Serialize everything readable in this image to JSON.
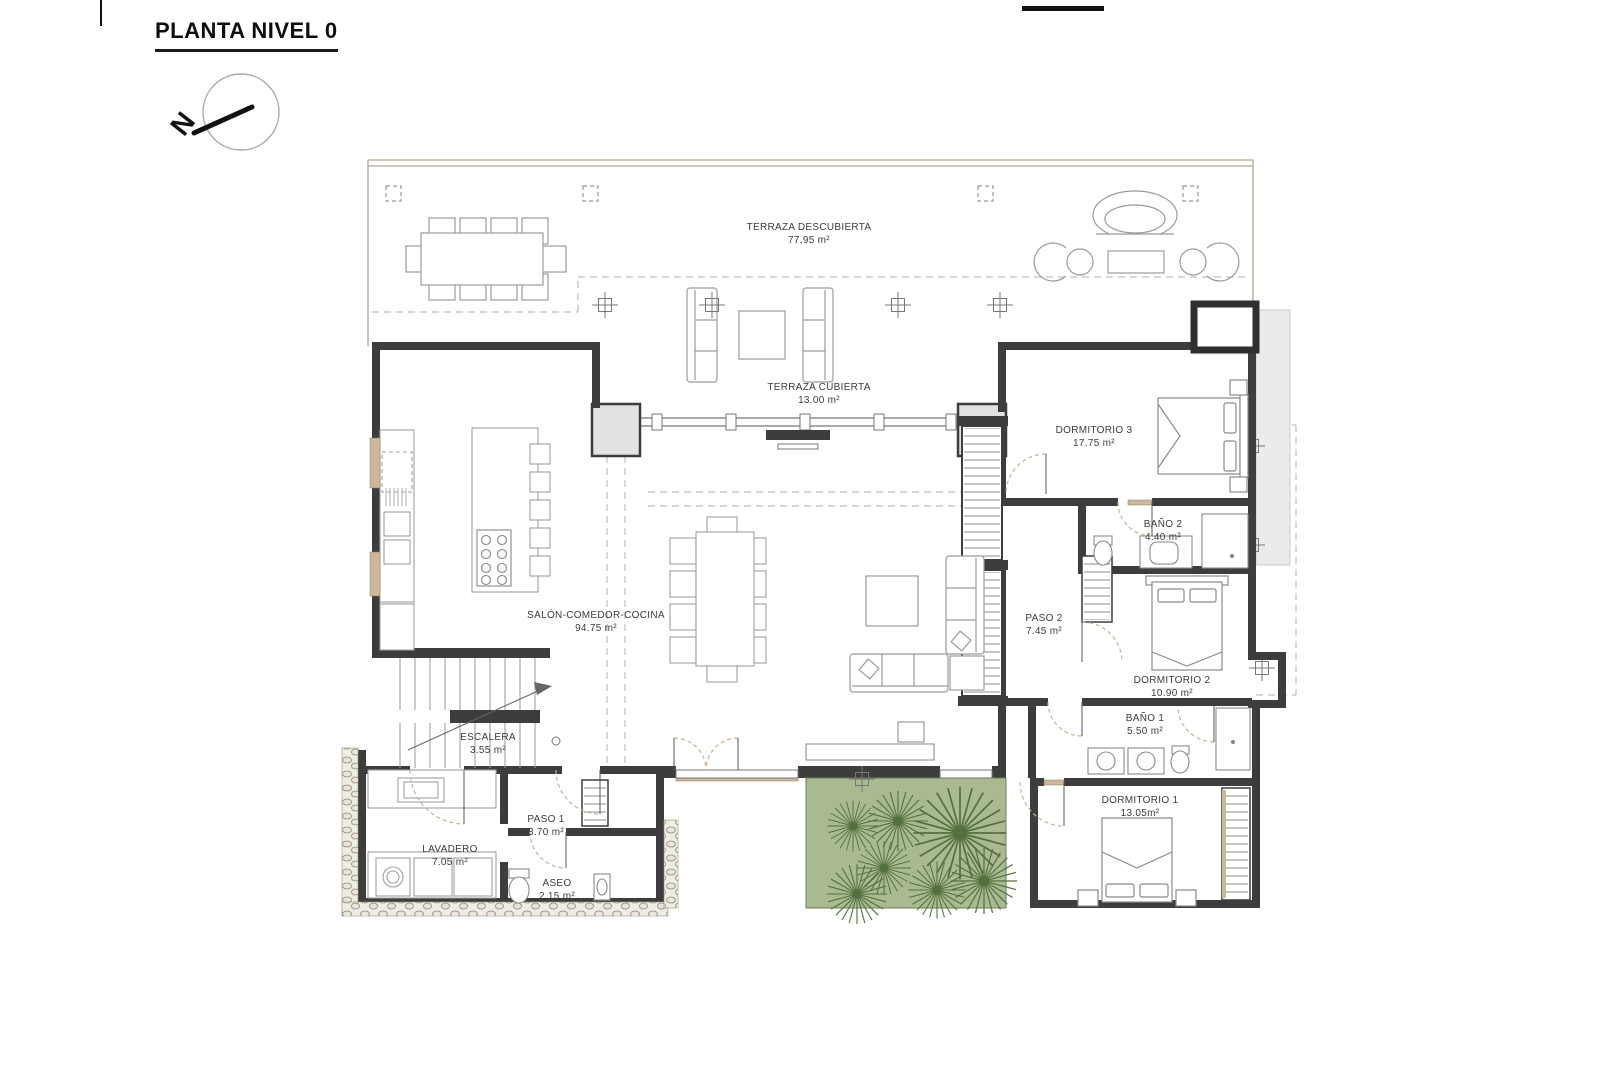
{
  "title": "PLANTA NIVEL 0",
  "compass": {
    "north_letter": "N"
  },
  "rooms": [
    {
      "id": "terraza-descubierta",
      "name": "TERRAZA DESCUBIERTA",
      "area": "77,95 m²"
    },
    {
      "id": "terraza-cubierta",
      "name": "TERRAZA CUBIERTA",
      "area": "13.00 m²"
    },
    {
      "id": "salon-comedor-cocina",
      "name": "SALÓN-COMEDOR-COCINA",
      "area": "94.75 m²"
    },
    {
      "id": "escalera",
      "name": "ESCALERA",
      "area": "3.55 m²"
    },
    {
      "id": "paso-1",
      "name": "PASO 1",
      "area": "3.70 m²"
    },
    {
      "id": "lavadero",
      "name": "LAVADERO",
      "area": "7.05 m²"
    },
    {
      "id": "aseo",
      "name": "ASEO",
      "area": "2.15 m²"
    },
    {
      "id": "dormitorio-3",
      "name": "DORMITORIO 3",
      "area": "17.75 m²"
    },
    {
      "id": "bano-2",
      "name": "BAÑO 2",
      "area": "4.40 m²"
    },
    {
      "id": "paso-2",
      "name": "PASO 2",
      "area": "7.45 m²"
    },
    {
      "id": "dormitorio-2",
      "name": "DORMITORIO 2",
      "area": "10.90 m²"
    },
    {
      "id": "bano-1",
      "name": "BAÑO 1",
      "area": "5.50 m²"
    },
    {
      "id": "dormitorio-1",
      "name": "DORMITORIO 1",
      "area": "13.05m²"
    }
  ],
  "colors": {
    "wall": "#3d3d3d",
    "wood_accent": "#c9b393",
    "property_line": "#b3a78d",
    "garden_fill": "#a9ba92",
    "plant_stroke": "#55703f",
    "furniture_line": "#9b9b9b"
  }
}
